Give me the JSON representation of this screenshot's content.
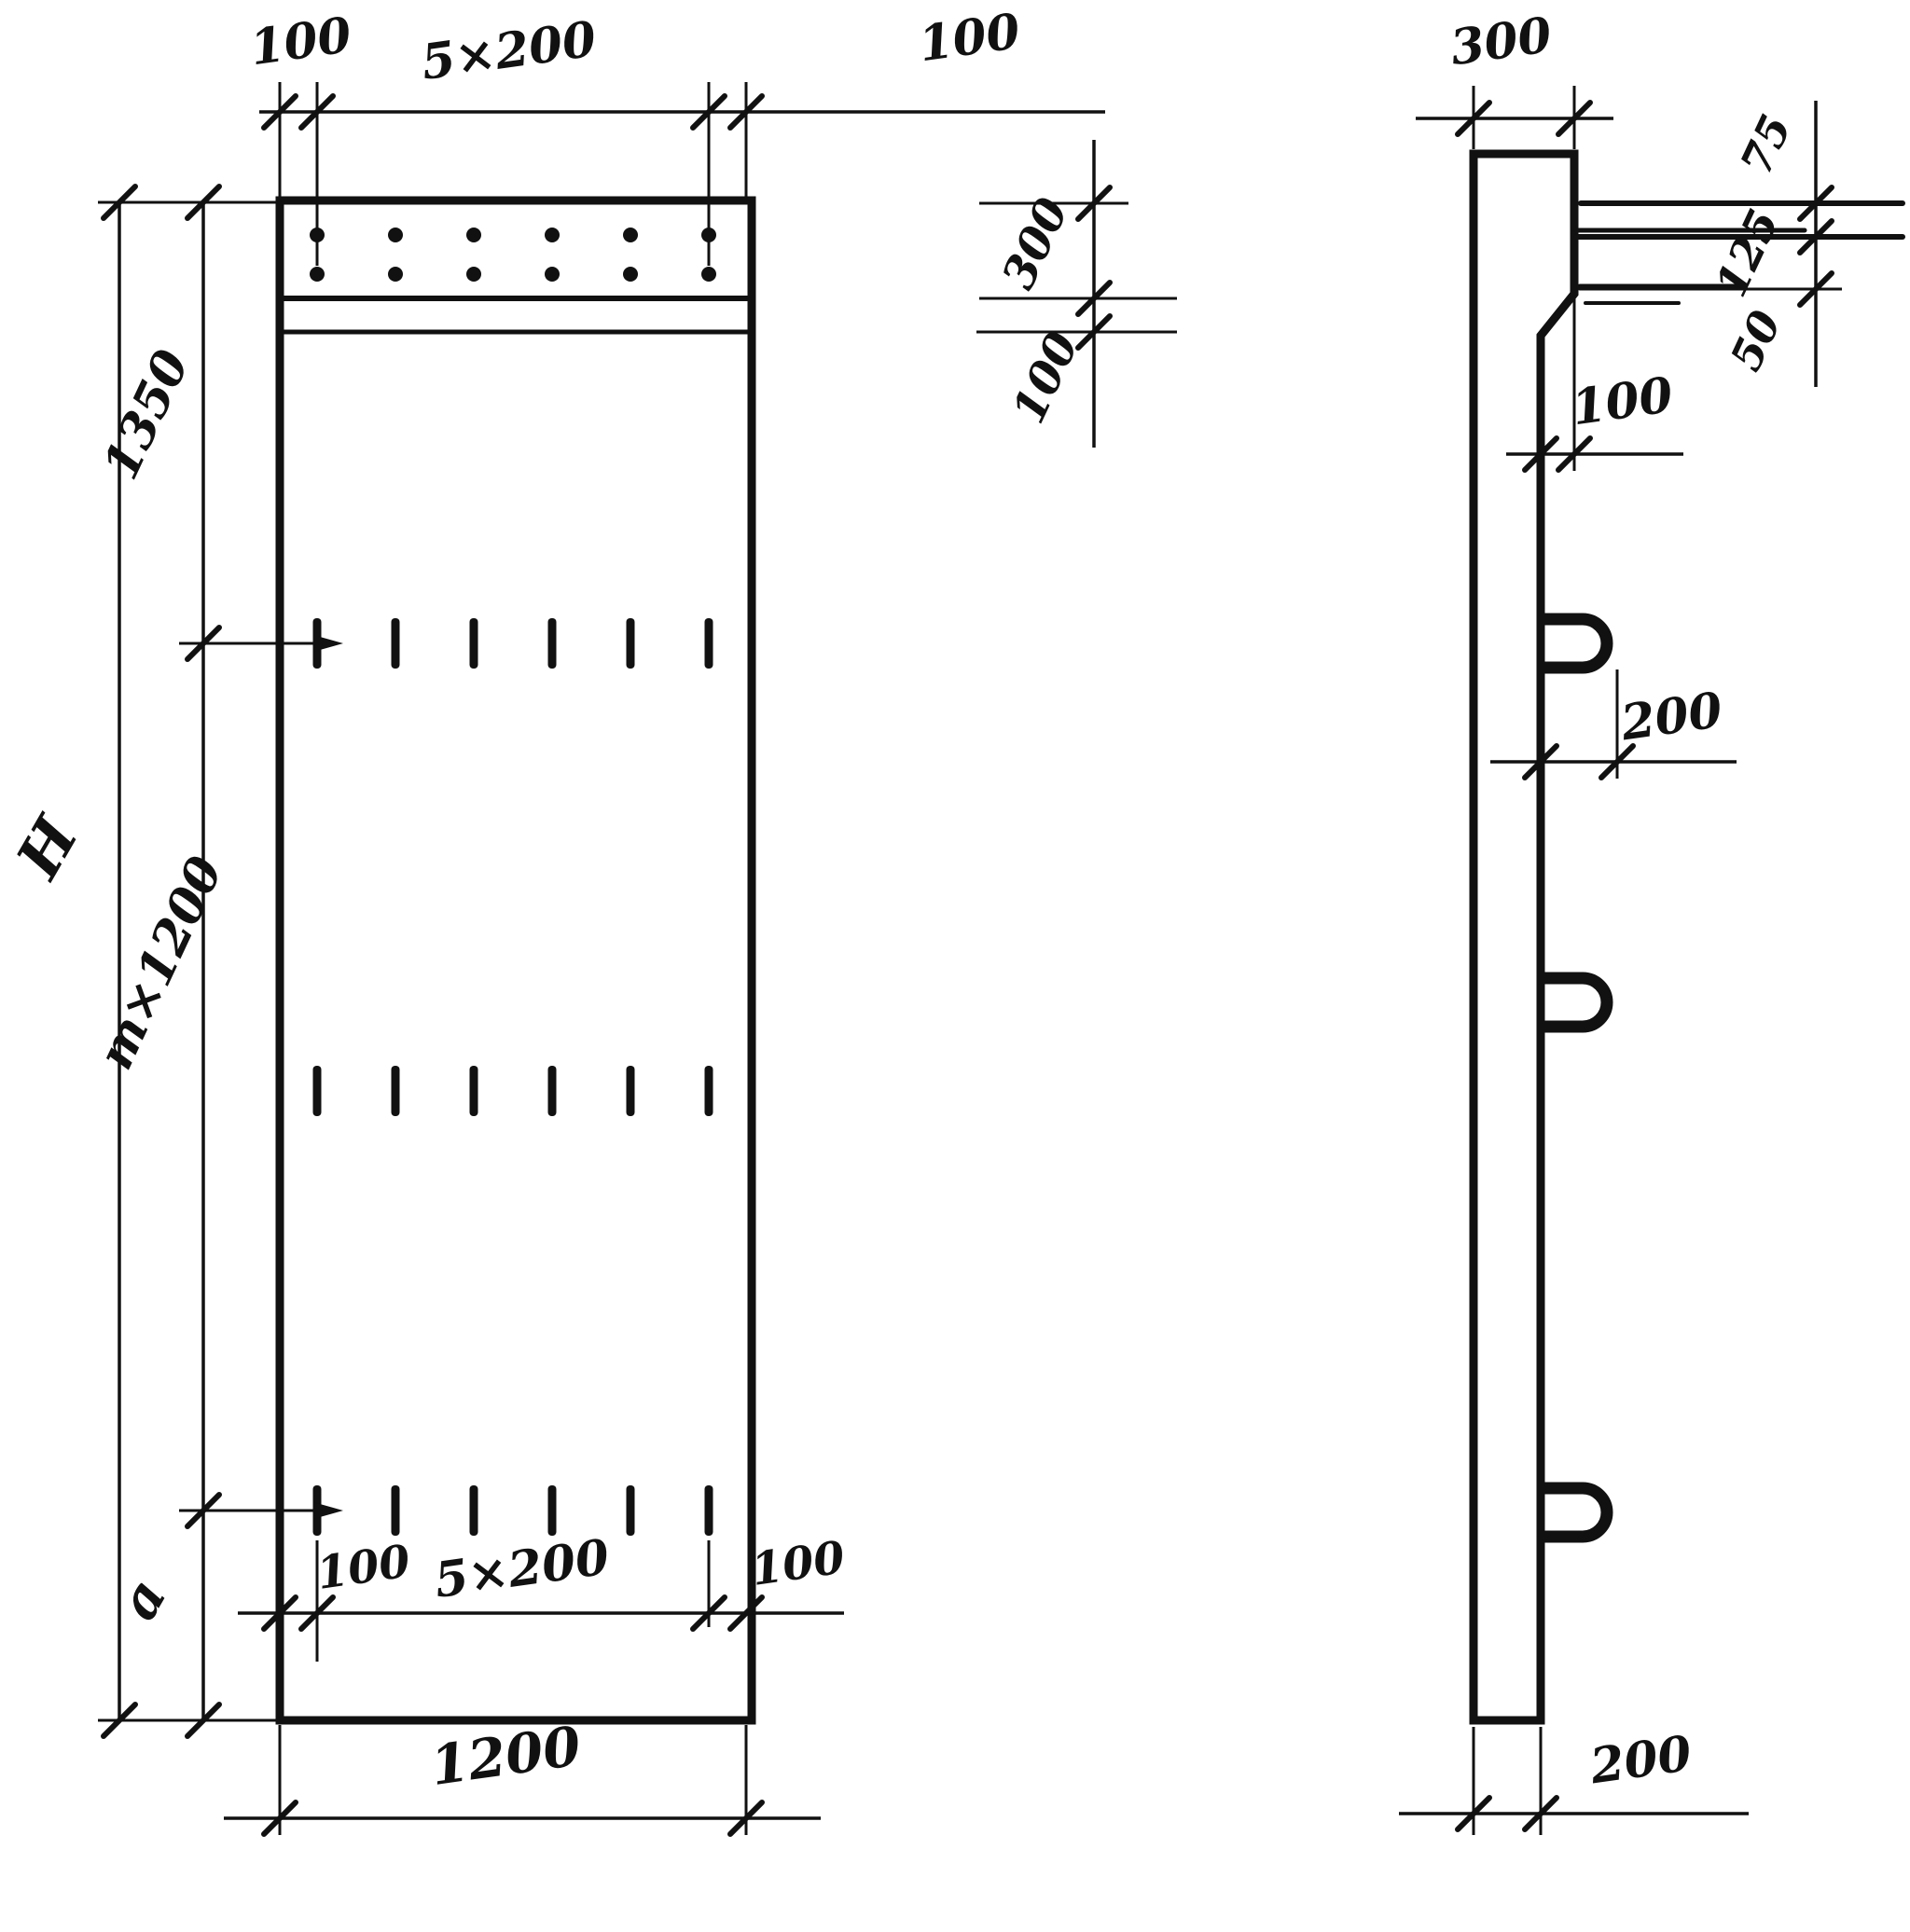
{
  "drawing": {
    "type": "technical-drawing",
    "subject": "precast concrete wall panel, front and side views",
    "units": "mm"
  },
  "front_view": {
    "dim_top_left": "100",
    "dim_top_spacing": "5×200",
    "dim_top_right": "100",
    "dim_band_height": "300",
    "dim_strip_height": "100",
    "dim_height_total": "H",
    "dim_height_top": "1350",
    "dim_height_middle": "m×1200",
    "dim_height_bottom": "a",
    "dim_bottom_left": "100",
    "dim_bottom_spacing": "5×200",
    "dim_bottom_right": "100",
    "dim_width": "1200"
  },
  "side_view": {
    "dim_top_width": "300",
    "dim_bar_top": "75",
    "dim_bar_mid": "125",
    "dim_bar_bottom": "50",
    "dim_chamfer_offset": "100",
    "dim_loop_length": "200",
    "dim_bottom_width": "200"
  }
}
